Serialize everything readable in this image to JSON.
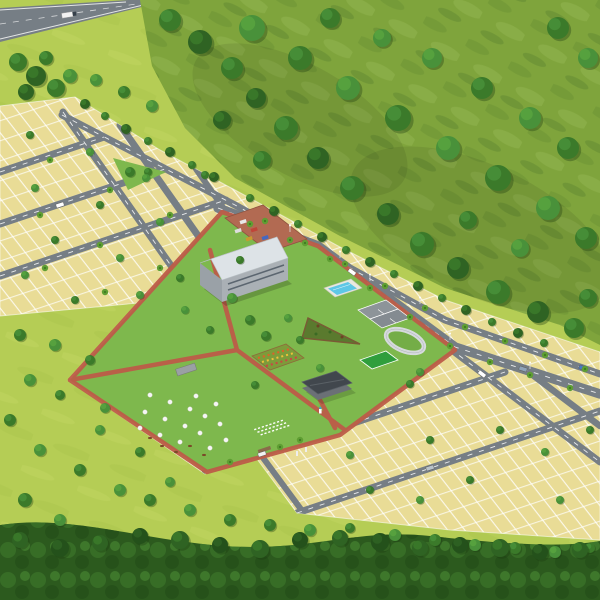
{
  "scene": {
    "type": "3d-aerial-site-plan-render",
    "subject": "hillside residential plotted development with central amenity park",
    "environment": [
      "tree-covered hillside",
      "forest belt at bottom",
      "open grassland",
      "highway at top-left"
    ]
  },
  "palette": {
    "grass_light": "#b5cd55",
    "grass_streak": "#c6da6d",
    "hill_green": "#7fa43c",
    "forest_green": "#2c5a1e",
    "plot_yellow": "#e9dc96",
    "plot_line": "#ffffff",
    "road_asphalt": "#767e85",
    "road_marking": "#ffffff",
    "lawn_green": "#7eb84d",
    "path_red": "#bd5c48",
    "parking_brick": "#b26a52",
    "roof_white": "#f2f5f7",
    "wall_grey": "#9aa1a7",
    "pool_blue": "#5ec7e6",
    "court_grey": "#8d9499",
    "sport_green": "#2f9e3c",
    "track_grey": "#d6dadd",
    "tree_dark": "#2f6323",
    "tree_light": "#49913a"
  },
  "features": {
    "landuse": [
      "residential plots",
      "amenity park",
      "green buffer",
      "hillside reserve"
    ],
    "amenities": [
      "clubhouse",
      "car parking",
      "swimming pool",
      "tennis courts",
      "jogging track",
      "sports court",
      "triangle garden",
      "flower garden",
      "party lawn with round tables",
      "open-air seating rows",
      "pavilion",
      "walking paths"
    ],
    "infrastructure": [
      "main spine road",
      "internal grid roads",
      "entrance road",
      "street lights",
      "avenue trees",
      "highway"
    ]
  },
  "counts": {
    "cars_visible": 7,
    "trucks_visible": 1
  }
}
